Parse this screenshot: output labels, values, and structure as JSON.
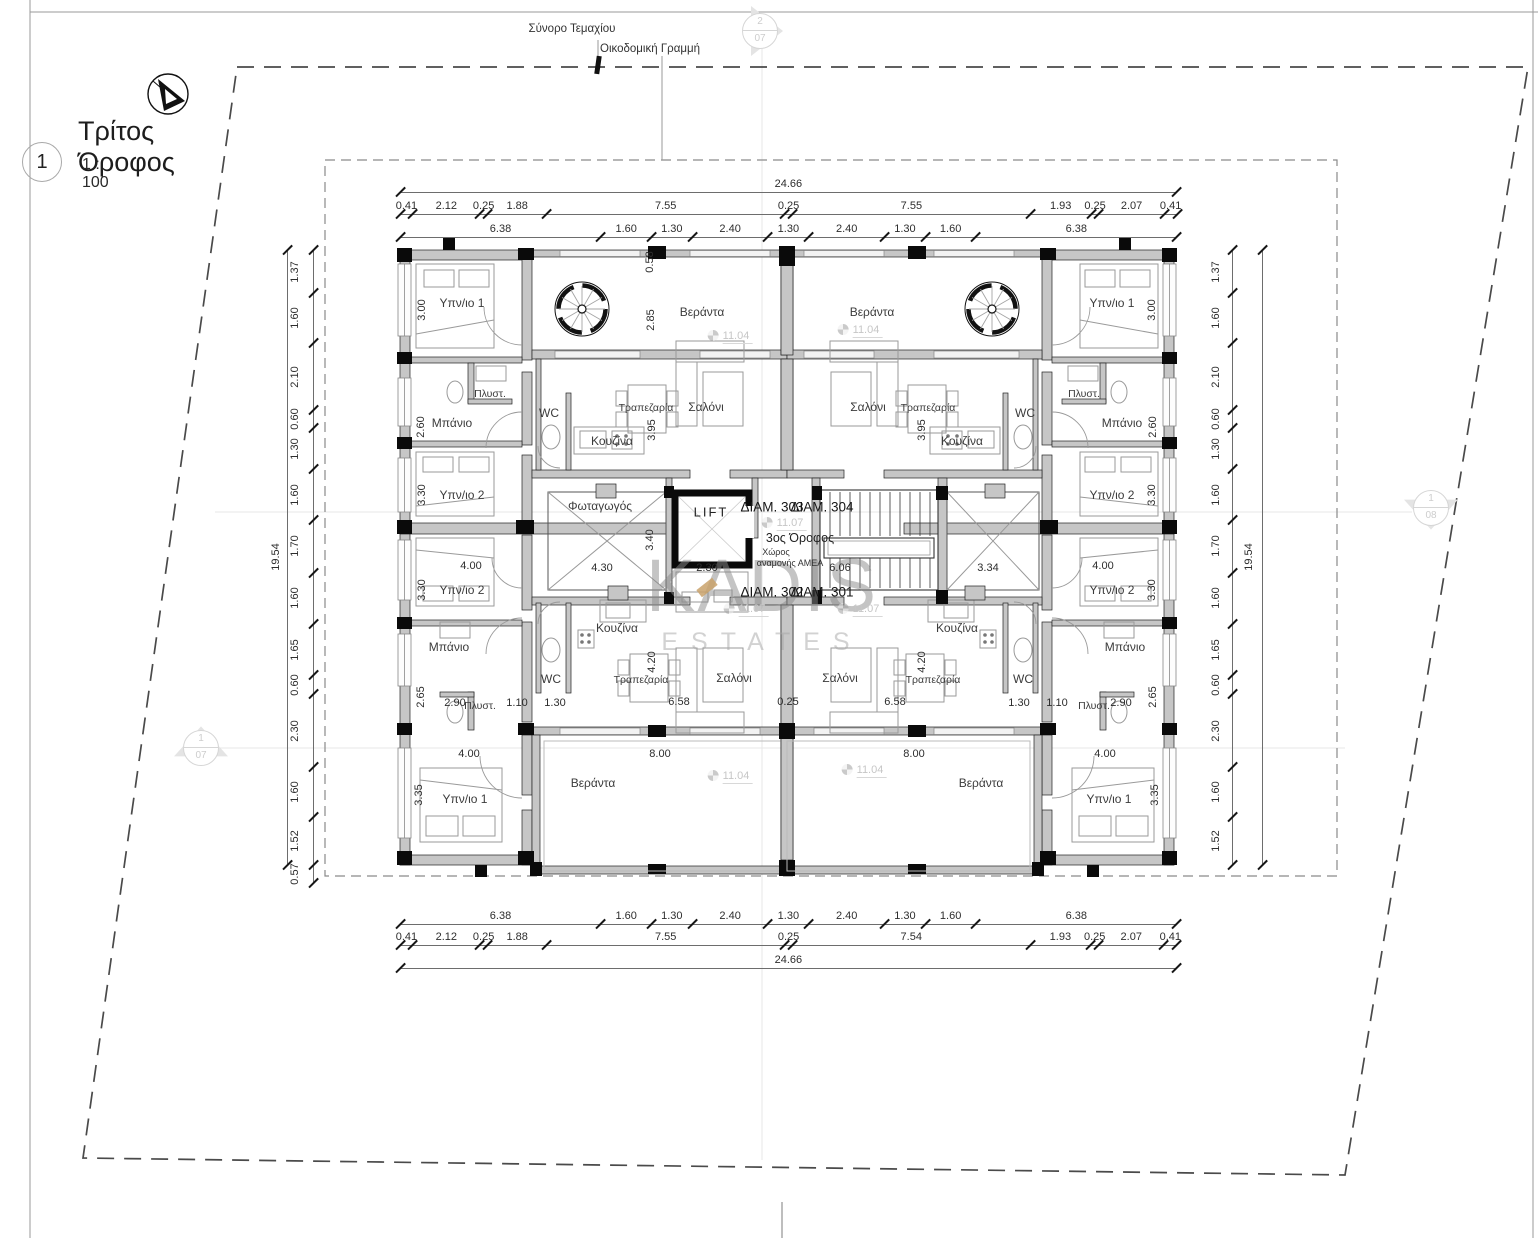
{
  "title_block": {
    "number": "1",
    "title": "Τρίτος Όροφος",
    "scale": "1 : 100"
  },
  "site_labels": {
    "boundary": "Σύνορο Τεμαχίου",
    "building_line": "Οικοδομική Γραμμή"
  },
  "watermark": {
    "line1": "KADIS",
    "line2": "ESTATES"
  },
  "markers": [
    {
      "top": "2",
      "bot": "07",
      "x": 760,
      "y": 31,
      "dir": "right"
    },
    {
      "top": "1",
      "bot": "08",
      "x": 1431,
      "y": 508,
      "dir": "down"
    },
    {
      "top": "1",
      "bot": "07",
      "x": 201,
      "y": 748,
      "dir": "up"
    }
  ],
  "chains": [
    {
      "o": "h",
      "x": 400,
      "ly": 192,
      "s": 31.5,
      "segs": [
        "24.66"
      ]
    },
    {
      "o": "h",
      "x": 400,
      "ly": 214,
      "s": 31.5,
      "segs": [
        "0.41",
        "2.12",
        "0.25",
        "1.88",
        "7.55",
        "0.25",
        "7.55",
        "1.93",
        "0.25",
        "2.07",
        "0.41"
      ]
    },
    {
      "o": "h",
      "x": 400,
      "ly": 237,
      "s": 31.5,
      "segs": [
        "6.38",
        "1.60",
        "1.30",
        "2.40",
        "1.30",
        "2.40",
        "1.30",
        "1.60",
        "6.38"
      ]
    },
    {
      "o": "h",
      "x": 400,
      "ly": 924,
      "s": 31.5,
      "segs": [
        "6.38",
        "1.60",
        "1.30",
        "2.40",
        "1.30",
        "2.40",
        "1.30",
        "1.60",
        "6.38"
      ]
    },
    {
      "o": "h",
      "x": 400,
      "ly": 945,
      "s": 31.5,
      "segs": [
        "0.41",
        "2.12",
        "0.25",
        "1.88",
        "7.55",
        "0.25",
        "7.54",
        "1.93",
        "0.25",
        "2.07",
        "0.41"
      ]
    },
    {
      "o": "h",
      "x": 400,
      "ly": 968,
      "s": 31.5,
      "segs": [
        "24.66"
      ]
    },
    {
      "o": "v",
      "lx": 313,
      "y": 250,
      "s": 31.47,
      "off": -18,
      "segs": [
        "1.37",
        "1.60",
        "2.10",
        "0.60",
        "1.30",
        "1.60",
        "1.70",
        "1.60",
        "1.65",
        "0.60",
        "2.30",
        "1.60",
        "1.52",
        "0.57"
      ]
    },
    {
      "o": "v",
      "lx": 287,
      "y": 250,
      "s": 31.47,
      "off": -11,
      "segs": [
        "19.54"
      ]
    },
    {
      "o": "v",
      "lx": 1232,
      "y": 250,
      "s": 31.47,
      "off": -16,
      "segs": [
        "1.37",
        "1.60",
        "2.10",
        "0.60",
        "1.30",
        "1.60",
        "1.70",
        "1.60",
        "1.65",
        "0.60",
        "2.30",
        "1.60",
        "1.52"
      ]
    },
    {
      "o": "v",
      "lx": 1262,
      "y": 250,
      "s": 31.47,
      "off": -13,
      "segs": [
        "19.54"
      ]
    }
  ],
  "plan_labels": [
    {
      "t": "Υπν/ιο 1",
      "x": 462,
      "y": 303,
      "c": "room"
    },
    {
      "t": "Μπάνιο",
      "x": 452,
      "y": 423,
      "c": "room"
    },
    {
      "t": "Πλυστ.",
      "x": 490,
      "y": 394,
      "c": "small"
    },
    {
      "t": "WC",
      "x": 549,
      "y": 413,
      "c": "room"
    },
    {
      "t": "Κουζίνα",
      "x": 612,
      "y": 441,
      "c": "room"
    },
    {
      "t": "Τραπεζαρία",
      "x": 646,
      "y": 408,
      "c": "small"
    },
    {
      "t": "Σαλόνι",
      "x": 706,
      "y": 407,
      "c": "room"
    },
    {
      "t": "Βεράντα",
      "x": 702,
      "y": 312,
      "c": "room"
    },
    {
      "t": "Υπν/ιο 1",
      "x": 1112,
      "y": 303,
      "c": "room"
    },
    {
      "t": "Μπάνιο",
      "x": 1122,
      "y": 423,
      "c": "room"
    },
    {
      "t": "Πλυστ.",
      "x": 1084,
      "y": 394,
      "c": "small"
    },
    {
      "t": "WC",
      "x": 1025,
      "y": 413,
      "c": "room"
    },
    {
      "t": "Κουζίνα",
      "x": 962,
      "y": 441,
      "c": "room"
    },
    {
      "t": "Τραπεζαρία",
      "x": 928,
      "y": 408,
      "c": "small"
    },
    {
      "t": "Σαλόνι",
      "x": 868,
      "y": 407,
      "c": "room"
    },
    {
      "t": "Βεράντα",
      "x": 872,
      "y": 312,
      "c": "room"
    },
    {
      "t": "Φωταγωγός",
      "x": 600,
      "y": 506,
      "c": "room"
    },
    {
      "t": "LIFT",
      "x": 711,
      "y": 512,
      "c": "lift"
    },
    {
      "t": "ΔΙΑΜ. 303",
      "x": 772,
      "y": 507,
      "c": "diam"
    },
    {
      "t": "ΔΙΑΜ. 304",
      "x": 822,
      "y": 507,
      "c": "diam"
    },
    {
      "t": "3ος Όροφος",
      "x": 800,
      "y": 538,
      "c": "floor"
    },
    {
      "t": "Χώρος",
      "x": 776,
      "y": 552,
      "c": "tiny"
    },
    {
      "t": "αναμονής ΑΜΕΑ",
      "x": 790,
      "y": 563,
      "c": "tiny"
    },
    {
      "t": "ΔΙΑΜ. 302",
      "x": 772,
      "y": 592,
      "c": "diam"
    },
    {
      "t": "ΔΙΑΜ. 301",
      "x": 822,
      "y": 592,
      "c": "diam"
    },
    {
      "t": "Υπν/ιο 2",
      "x": 462,
      "y": 495,
      "c": "room"
    },
    {
      "t": "Υπν/ιο 2",
      "x": 462,
      "y": 590,
      "c": "room"
    },
    {
      "t": "Μπάνιο",
      "x": 449,
      "y": 647,
      "c": "room"
    },
    {
      "t": "Πλυστ.",
      "x": 480,
      "y": 706,
      "c": "small"
    },
    {
      "t": "Κουζίνα",
      "x": 617,
      "y": 628,
      "c": "room"
    },
    {
      "t": "Τραπεζαρία",
      "x": 641,
      "y": 680,
      "c": "small"
    },
    {
      "t": "Σαλόνι",
      "x": 734,
      "y": 678,
      "c": "room"
    },
    {
      "t": "WC",
      "x": 551,
      "y": 679,
      "c": "room"
    },
    {
      "t": "Βεράντα",
      "x": 593,
      "y": 783,
      "c": "room"
    },
    {
      "t": "Υπν/ιο 1",
      "x": 465,
      "y": 799,
      "c": "room"
    },
    {
      "t": "Υπν/ιο 2",
      "x": 1112,
      "y": 495,
      "c": "room"
    },
    {
      "t": "Υπν/ιο 2",
      "x": 1112,
      "y": 590,
      "c": "room"
    },
    {
      "t": "Μπάνιο",
      "x": 1125,
      "y": 647,
      "c": "room"
    },
    {
      "t": "Πλυστ.",
      "x": 1094,
      "y": 706,
      "c": "small"
    },
    {
      "t": "Κουζίνα",
      "x": 957,
      "y": 628,
      "c": "room"
    },
    {
      "t": "Τραπεζαρία",
      "x": 933,
      "y": 680,
      "c": "small"
    },
    {
      "t": "Σαλόνι",
      "x": 840,
      "y": 678,
      "c": "room"
    },
    {
      "t": "WC",
      "x": 1023,
      "y": 679,
      "c": "room"
    },
    {
      "t": "Βεράντα",
      "x": 981,
      "y": 783,
      "c": "room"
    },
    {
      "t": "Υπν/ιο 1",
      "x": 1109,
      "y": 799,
      "c": "room"
    },
    {
      "t": "3.00",
      "x": 422,
      "y": 310,
      "c": "dimv"
    },
    {
      "t": "2.60",
      "x": 421,
      "y": 427,
      "c": "dimv"
    },
    {
      "t": "3.30",
      "x": 422,
      "y": 495,
      "c": "dimv"
    },
    {
      "t": "3.30",
      "x": 422,
      "y": 590,
      "c": "dimv"
    },
    {
      "t": "2.65",
      "x": 421,
      "y": 697,
      "c": "dimv"
    },
    {
      "t": "3.35",
      "x": 419,
      "y": 795,
      "c": "dimv"
    },
    {
      "t": "3.00",
      "x": 1152,
      "y": 310,
      "c": "dimv"
    },
    {
      "t": "2.60",
      "x": 1153,
      "y": 427,
      "c": "dimv"
    },
    {
      "t": "3.30",
      "x": 1152,
      "y": 495,
      "c": "dimv"
    },
    {
      "t": "3.30",
      "x": 1152,
      "y": 590,
      "c": "dimv"
    },
    {
      "t": "2.65",
      "x": 1153,
      "y": 697,
      "c": "dimv"
    },
    {
      "t": "3.35",
      "x": 1155,
      "y": 795,
      "c": "dimv"
    },
    {
      "t": "0.58",
      "x": 650,
      "y": 262,
      "c": "dimv"
    },
    {
      "t": "2.85",
      "x": 651,
      "y": 320,
      "c": "dimv"
    },
    {
      "t": "3.95",
      "x": 652,
      "y": 430,
      "c": "dimv"
    },
    {
      "t": "3.95",
      "x": 922,
      "y": 430,
      "c": "dimv"
    },
    {
      "t": "3.40",
      "x": 650,
      "y": 540,
      "c": "dimv"
    },
    {
      "t": "4.30",
      "x": 602,
      "y": 568,
      "c": "dim"
    },
    {
      "t": "2.30",
      "x": 707,
      "y": 568,
      "c": "dim"
    },
    {
      "t": "6.06",
      "x": 840,
      "y": 568,
      "c": "dim"
    },
    {
      "t": "3.34",
      "x": 988,
      "y": 568,
      "c": "dim"
    },
    {
      "t": "4.00",
      "x": 471,
      "y": 566,
      "c": "dim"
    },
    {
      "t": "4.00",
      "x": 1103,
      "y": 566,
      "c": "dim"
    },
    {
      "t": "2.90",
      "x": 455,
      "y": 703,
      "c": "dim"
    },
    {
      "t": "1.10",
      "x": 517,
      "y": 703,
      "c": "dim"
    },
    {
      "t": "1.30",
      "x": 555,
      "y": 703,
      "c": "dim"
    },
    {
      "t": "1.30",
      "x": 1019,
      "y": 703,
      "c": "dim"
    },
    {
      "t": "1.10",
      "x": 1057,
      "y": 703,
      "c": "dim"
    },
    {
      "t": "2.90",
      "x": 1121,
      "y": 703,
      "c": "dim"
    },
    {
      "t": "4.20",
      "x": 652,
      "y": 662,
      "c": "dimv"
    },
    {
      "t": "4.20",
      "x": 922,
      "y": 662,
      "c": "dimv"
    },
    {
      "t": "6.58",
      "x": 679,
      "y": 702,
      "c": "dim"
    },
    {
      "t": "0.25",
      "x": 788,
      "y": 702,
      "c": "dim"
    },
    {
      "t": "6.58",
      "x": 895,
      "y": 702,
      "c": "dim"
    },
    {
      "t": "4.00",
      "x": 469,
      "y": 754,
      "c": "dim"
    },
    {
      "t": "8.00",
      "x": 660,
      "y": 754,
      "c": "dim"
    },
    {
      "t": "8.00",
      "x": 914,
      "y": 754,
      "c": "dim"
    },
    {
      "t": "4.00",
      "x": 1105,
      "y": 754,
      "c": "dim"
    },
    {
      "t": "11.04",
      "x": 730,
      "y": 336,
      "c": "level"
    },
    {
      "t": "11.04",
      "x": 860,
      "y": 330,
      "c": "level"
    },
    {
      "t": "11.04",
      "x": 730,
      "y": 776,
      "c": "level"
    },
    {
      "t": "11.04",
      "x": 864,
      "y": 770,
      "c": "level"
    },
    {
      "t": "11.07",
      "x": 784,
      "y": 523,
      "c": "level"
    },
    {
      "t": "11.07",
      "x": 746,
      "y": 609,
      "c": "level"
    },
    {
      "t": "11.07",
      "x": 860,
      "y": 609,
      "c": "level"
    }
  ]
}
